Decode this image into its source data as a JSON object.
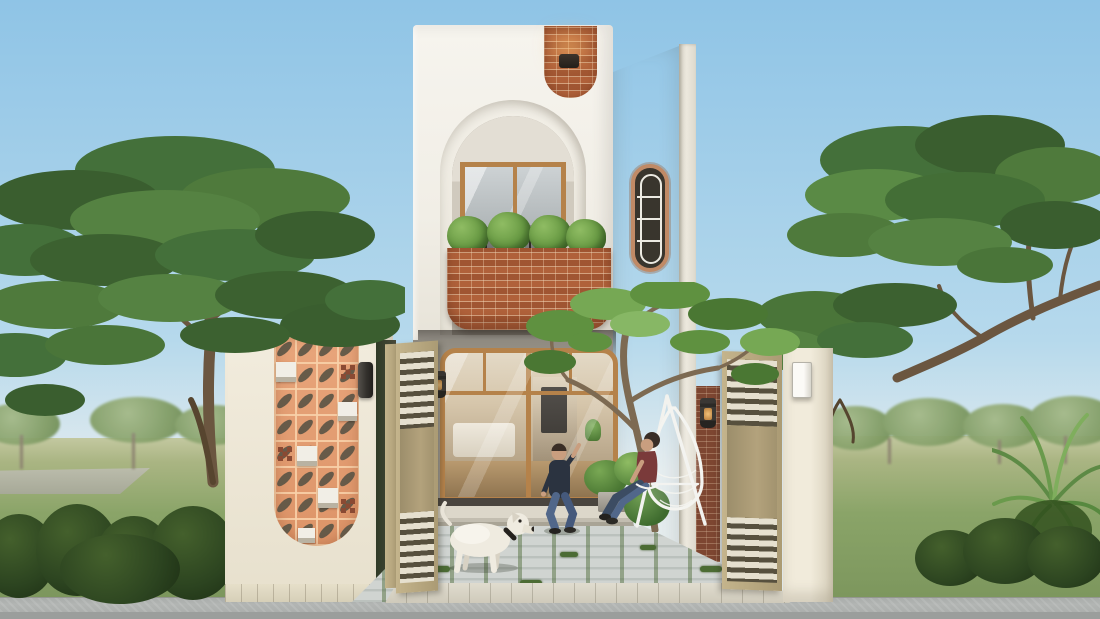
{
  "scene": {
    "type": "architectural-exterior-render",
    "description": "3D rendering of a narrow modern two-storey house with white facade and brick accents: arched recessed balcony with wooden window, plants in a brick planter box, brick chimney inset with lamp, capsule side window, glass ground-floor wall showing a living room, terracotta breeze-block boundary wall, open slatted gates, front yard of grass-joint pavers with a white dog, a child playing, and a woman on a white swing chair under a frangipani tree, flanked by large green trees and lawns under a clear blue sky",
    "elements": {
      "sky": "clear pale blue sky",
      "left_lawn": "lawn with hazy distant trees and a grey path",
      "right_lawn": "open lawn with distant tree line, palm fronds and shrubs",
      "hedge": "dark clipped hedge along the left sidewalk",
      "sidewalk": "grey paved sidewalk and road edge",
      "left_tree": "large layered-canopy tree overhanging from the left",
      "right_tree": "tall tree leaning in from the right",
      "boundary_wall": "cream wall with U-shaped terracotta breeze-block panel and cylinder lamp",
      "left_gate": "open tan gate with horizontal slats",
      "right_gate": "open tan gate with slatted top and bottom panels",
      "gate_pillar": "cream pillar with modern box sconce",
      "house_upper": "white facade, brick chimney inset with glowing lamp, arched balcony recess",
      "balcony": "wooden window, dark metal railing, four green shrubs, hanging brick planter",
      "capsule_window": "vertical capsule window with terracotta trim and white grille",
      "ground_floor": "wood-framed glass wall revealing warm living room with sofa and TV",
      "wall_lanterns": "classic black lanterns beside door and on brick pier",
      "yard_paving": "long grey pavers with grass joints",
      "frangipani_tree": "slender ornamental tree over the yard",
      "swing_chair": "white teardrop swing chair on A-frame stand",
      "woman": "woman in maroon shirt and jeans seated on swing",
      "child": "child in dark shirt and jeans playing, arm raised",
      "dog": "white dog with black collar walking on pavers"
    }
  },
  "palette": {
    "sky_top": "#8fc4e6",
    "sky_mid": "#b6d9ec",
    "sky_horizon": "#e2ebee",
    "facade": "#f1eee6",
    "ground_wall": "#a39e95",
    "brick": "#b0613a",
    "breeze": "#e8a57b",
    "wood": "#b5824a",
    "railing": "#2e2b27",
    "plant": "#699b44",
    "plant_light": "#8fbc63",
    "field": "#8aa468",
    "field_light": "#aab583",
    "hedge": "#2c4420",
    "sidewalk": "#b2b5b3",
    "gate": "#b3a27c",
    "swing_white": "#f4f4f0",
    "shirt_maroon": "#7a3a3a",
    "jeans": "#51678a",
    "dog_white": "#efebe0",
    "skin": "#c99e7f"
  }
}
